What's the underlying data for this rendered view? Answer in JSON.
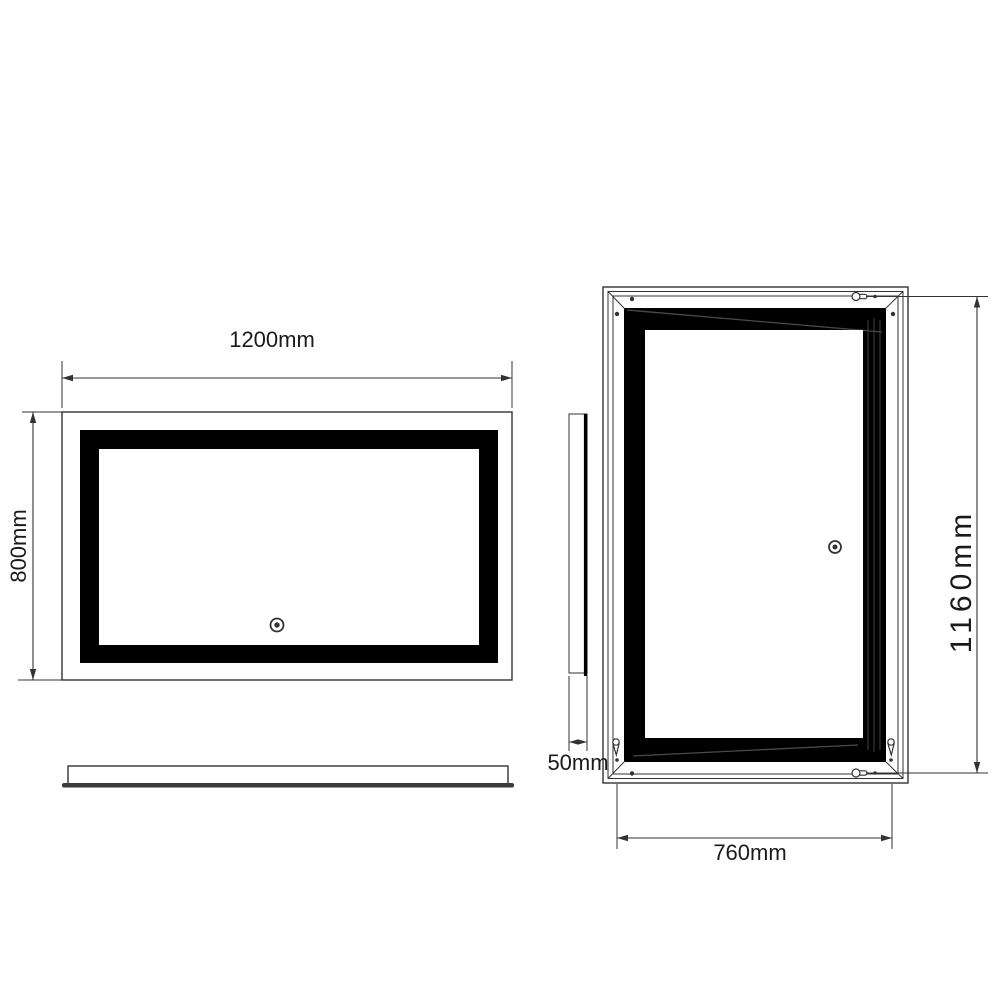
{
  "front_view": {
    "width_label": "1200mm",
    "height_label": "800mm"
  },
  "back_view": {
    "width_label": "760mm",
    "height_label": "1160mm"
  },
  "side_view": {
    "depth_label": "50mm"
  },
  "colors": {
    "line": "#333333",
    "text": "#1a1a1a",
    "frame_black": "#000000",
    "background": "#ffffff"
  }
}
